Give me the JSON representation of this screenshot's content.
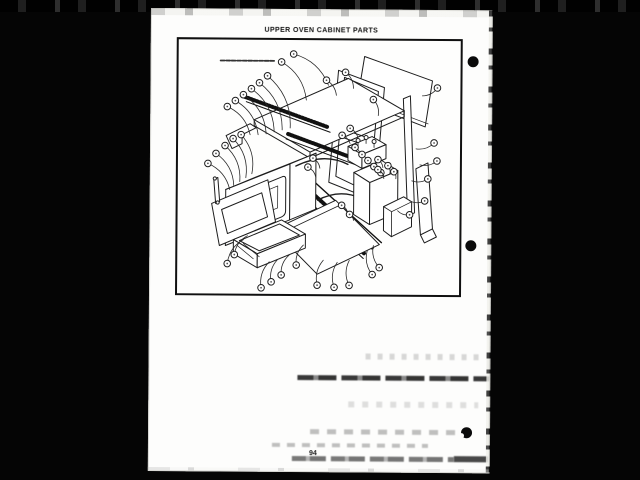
{
  "page": {
    "title": "UPPER OVEN CABINET PARTS",
    "page_number": "94",
    "figure_alt": "Exploded isometric parts diagram of the upper oven cabinet with numbered callout balloons and leader lines"
  }
}
